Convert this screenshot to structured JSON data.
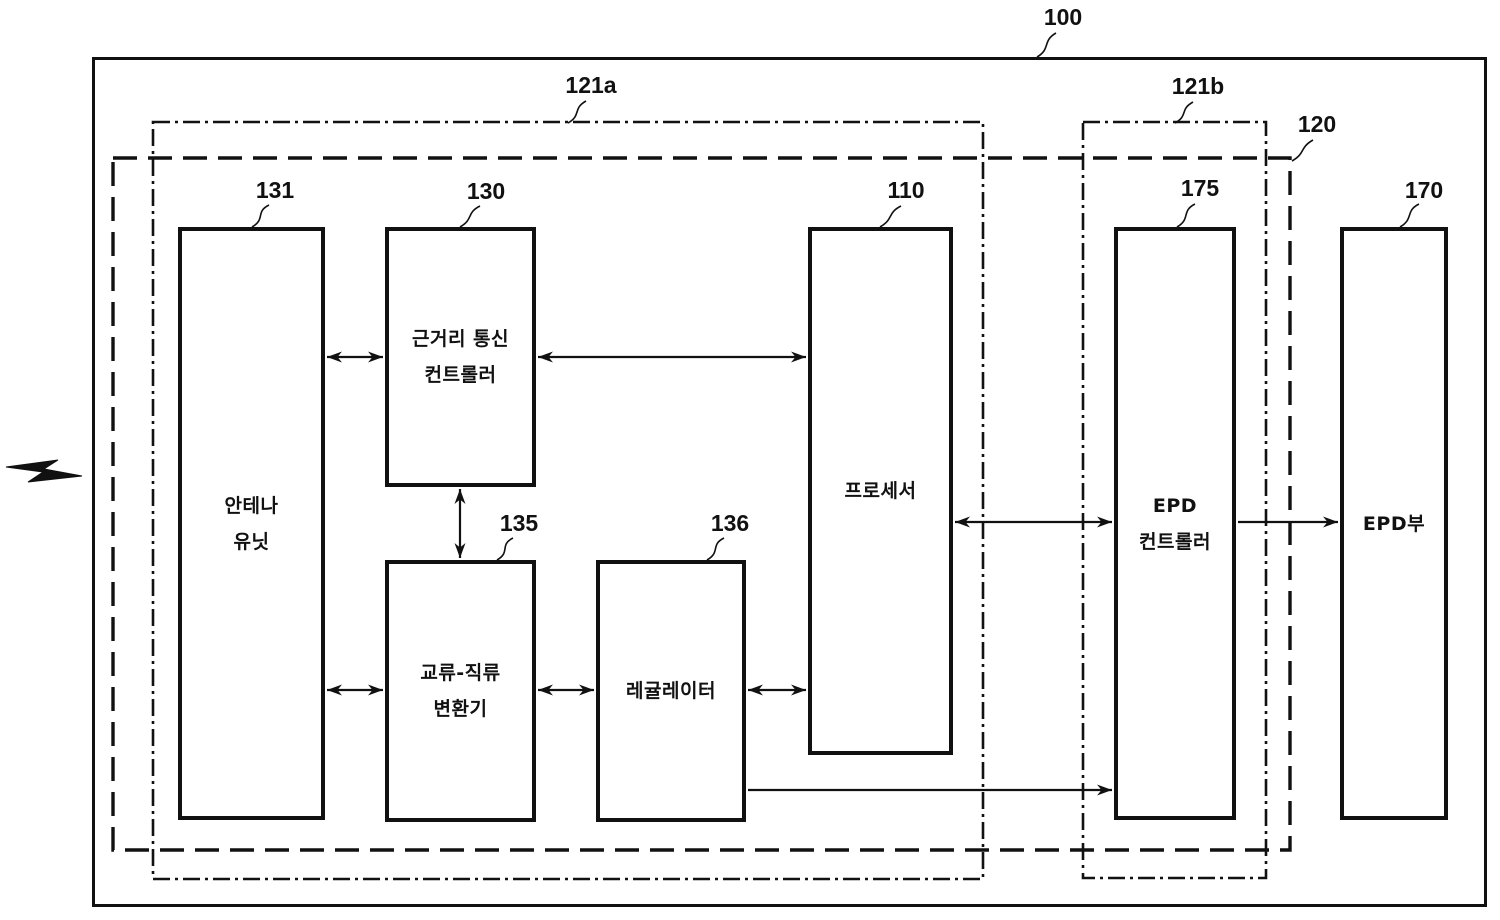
{
  "colors": {
    "line": "#111111",
    "background": "#ffffff"
  },
  "ref_labels": {
    "outer_box": "100",
    "left_dashdot_box": "121a",
    "right_dashdot_box": "121b",
    "dashed_box": "120",
    "antenna": "131",
    "nfc_controller": "130",
    "ac_dc_converter": "135",
    "regulator": "136",
    "processor": "110",
    "epd_controller": "175",
    "epd_unit": "170"
  },
  "blocks": {
    "antenna": {
      "line1": "안테나",
      "line2": "유닛"
    },
    "nfc_controller": {
      "line1": "근거리 통신",
      "line2": "컨트롤러"
    },
    "ac_dc_converter": {
      "line1": "교류-직류",
      "line2": "변환기"
    },
    "regulator": {
      "line1": "레귤레이터"
    },
    "processor": {
      "line1": "프로세서"
    },
    "epd_controller": {
      "line1": "EPD",
      "line2": "컨트롤러"
    },
    "epd_unit": {
      "line1": "EPD부"
    }
  }
}
